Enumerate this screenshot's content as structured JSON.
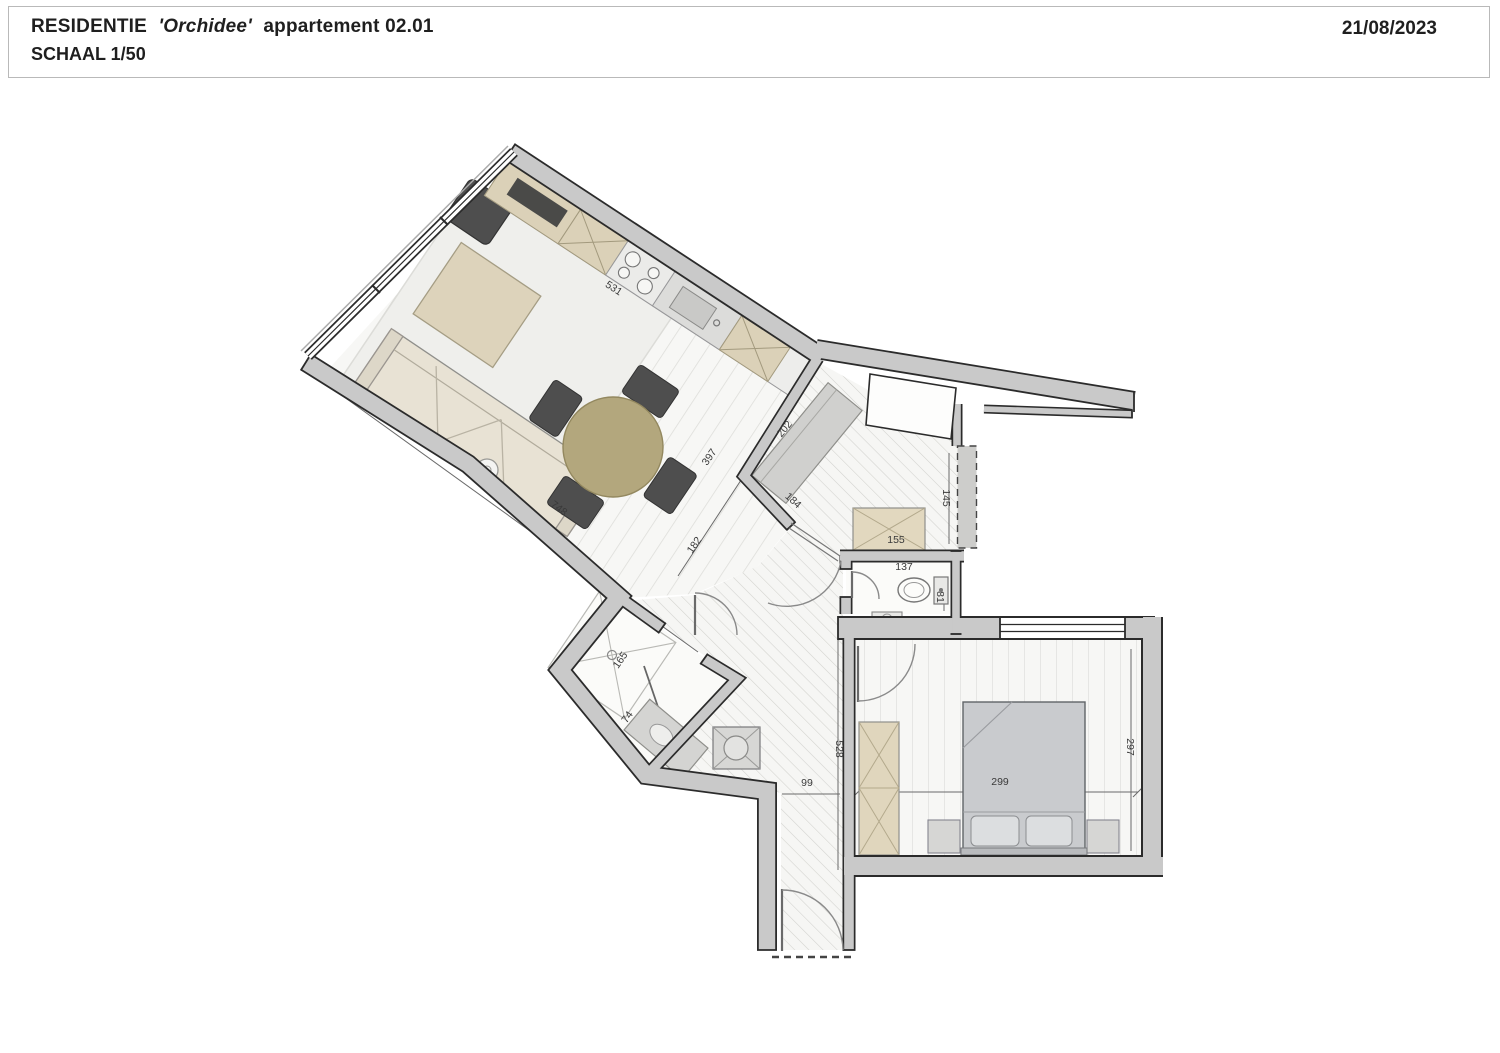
{
  "header": {
    "project": "RESIDENTIE",
    "residence_name": "'Orchidee'",
    "unit": "appartement 02.01",
    "scale": "SCHAAL 1/50",
    "date": "21/08/2023"
  },
  "plan": {
    "dims": {
      "kitchen_counter": "531",
      "living_length": "748",
      "living_width": "397",
      "living_door_offset": "182",
      "hall_cabinet": "202",
      "hall_wall": "184",
      "hall_width": "145",
      "storage_cabinet": "155",
      "toilet_width": "137",
      "toilet_depth": "81",
      "shower_width": "165",
      "vanity_width": "74",
      "entry_width": "99",
      "entry_length": "528",
      "bedroom_width": "299",
      "bedroom_depth": "297"
    },
    "colors": {
      "wall_fill": "#c9c9c9",
      "wall_line": "#2b2b2b",
      "furniture_dark": "#4e4e4e",
      "wood_beige": "#dbd1b8",
      "table_olive": "#b3a77d"
    }
  }
}
